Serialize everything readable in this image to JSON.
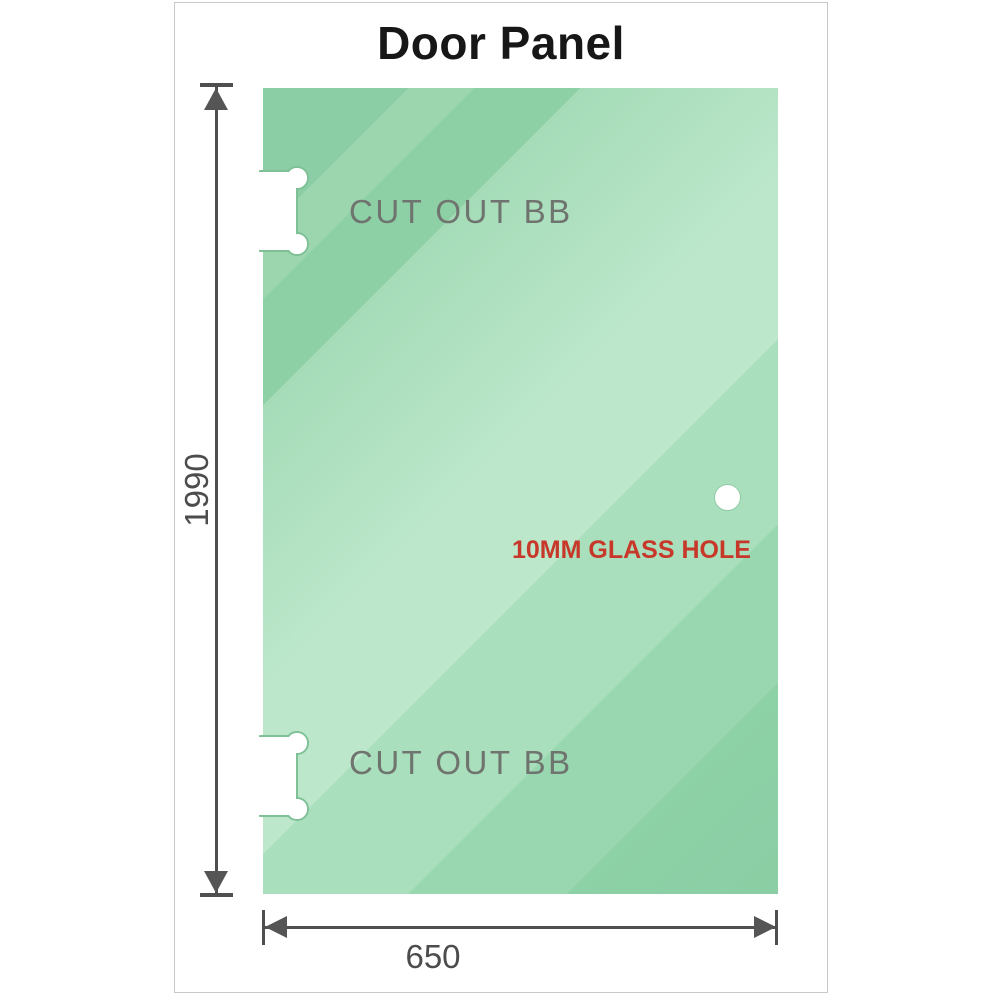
{
  "diagram": {
    "title": "Door Panel",
    "height_label": "1990",
    "width_label": "650",
    "cutouts": [
      {
        "label": "CUT OUT BB"
      },
      {
        "label": "CUT OUT BB"
      }
    ],
    "glass_hole_label": "10MM GLASS HOLE",
    "colors": {
      "glass_green_base": "#8bcda4",
      "glass_green_light": "#bce7cb",
      "dimension_gray": "#4f4f4f",
      "cutout_label_gray": "#70746f",
      "hole_label_red": "#c7382a",
      "frame_border_gray": "#c9c9c9",
      "title_black": "#171717"
    }
  }
}
